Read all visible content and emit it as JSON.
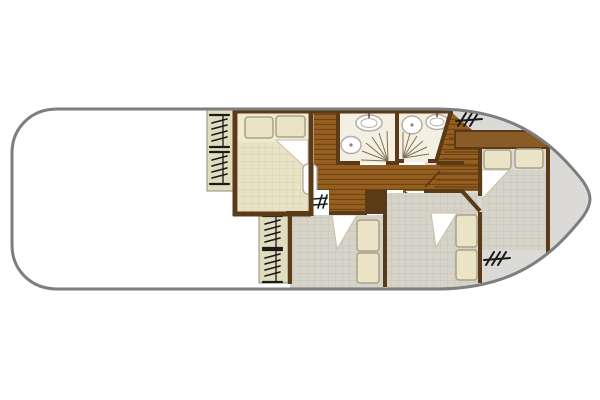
{
  "meta": {
    "kind": "boat-floor-plan",
    "aria_label": "Top-down interior floor plan of a canal boat: rounded stern on the left, pointed bow on the right, three cabins with double beds, two bathrooms, wooden central corridor and bow deck",
    "orientation": "bow-right",
    "visible_text": ""
  },
  "colors": {
    "hullStroke": "#7e7e81",
    "wall": "#5b3a17",
    "woodBase": "#975f1f",
    "plank": "#6e4514",
    "band": "#8a5b26",
    "bedCream": "#f1ead1",
    "duvet": "#e9e2c5",
    "duvetLine": "#dbd2b2",
    "pillow": "#ebe3c6",
    "pillowStroke": "#a7a389",
    "strip": "#e0ddbf",
    "stripStroke": "#8e8e7a",
    "bathFloor": "#f3efe2",
    "fixture": "#b3afa3",
    "greyFloor": "#d6d3c8",
    "greyGrid": "#c7c4b7",
    "deck": "#dbdad7",
    "fanLine": "#80704f",
    "symbol": "#1a1a1a",
    "foldStroke": "#c8c1a8"
  },
  "rooms": [
    {
      "id": "saloon-open-area",
      "position": "stern-left",
      "contents": []
    },
    {
      "id": "port-mid-cabin",
      "bed": "double",
      "pillows": 2,
      "duvet_fold": true,
      "window_icons": 2
    },
    {
      "id": "bathroom-port",
      "fixtures": [
        "sink",
        "toilet",
        "folding-door"
      ]
    },
    {
      "id": "bathroom-starboard",
      "fixtures": [
        "toilet",
        "sink",
        "folding-door"
      ]
    },
    {
      "id": "corridor",
      "features": [
        "wood-plank-floor",
        "stairs-to-bow",
        "step-markers",
        "door-openings"
      ]
    },
    {
      "id": "starboard-mid-cabin",
      "bed": "double",
      "pillows": 2,
      "duvet_fold": true,
      "window_icons": 2
    },
    {
      "id": "starboard-fwd-cabin",
      "bed": "double",
      "pillows": 2,
      "duvet_fold": true,
      "window_icons": 0
    },
    {
      "id": "bow-cabin",
      "bed": "double",
      "pillows": 2,
      "duvet_fold": true,
      "headboard_shelf": true,
      "window_icons": 1
    },
    {
      "id": "bow-deck",
      "features": [
        "steps-icon"
      ],
      "window_icons": 1
    }
  ]
}
